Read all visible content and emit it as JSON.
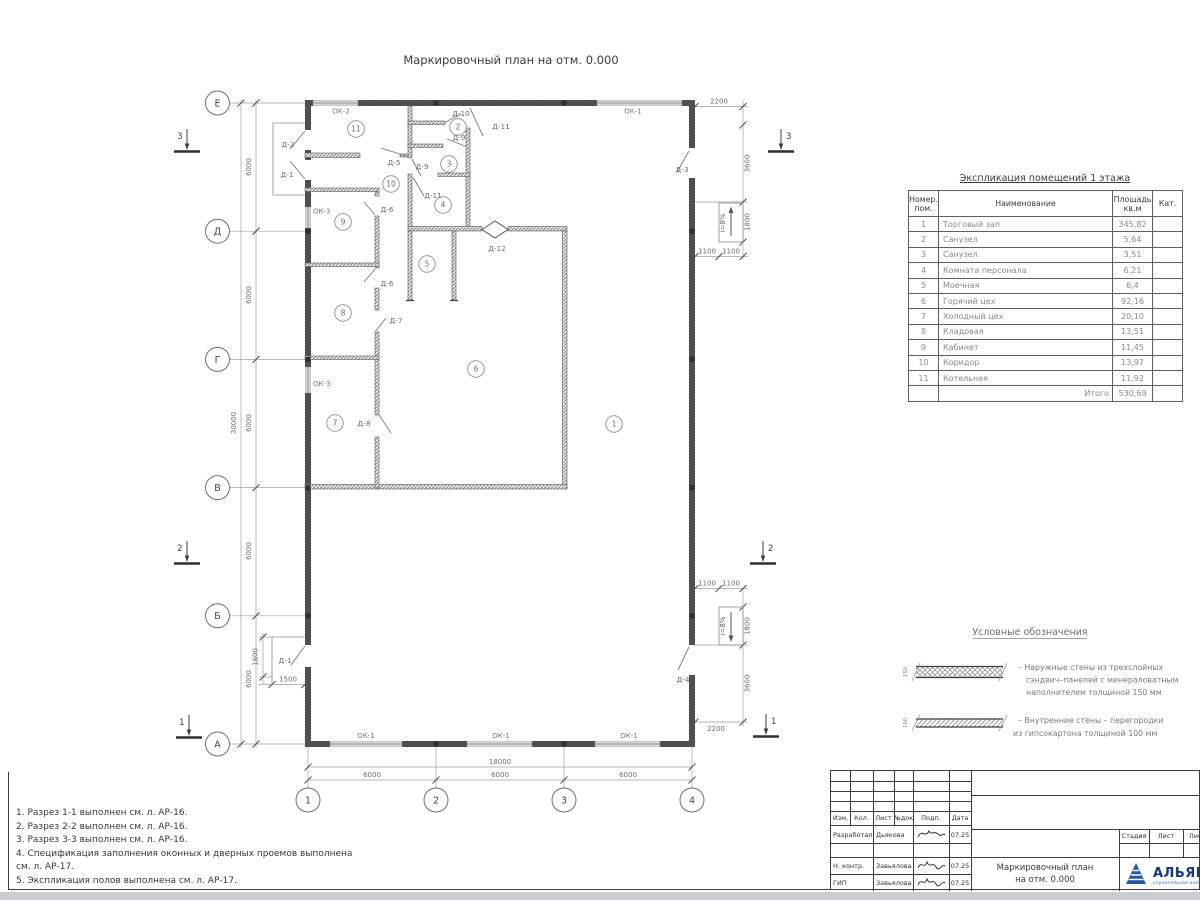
{
  "sheet": {
    "plan_title": "Маркировочный план на отм. 0.000"
  },
  "axes": {
    "rows": [
      "Е",
      "Д",
      "Г",
      "В",
      "Б",
      "А"
    ],
    "cols": [
      "1",
      "2",
      "3",
      "4"
    ]
  },
  "sections": {
    "s1": "1",
    "s2": "2",
    "s3": "3"
  },
  "rooms": [
    "1",
    "2",
    "3",
    "4",
    "5",
    "6",
    "7",
    "8",
    "9",
    "10",
    "11"
  ],
  "doors": {
    "d1": "Д-1",
    "d2": "Д-2",
    "d3": "Д-3",
    "d4": "Д-4",
    "d5": "Д-5",
    "d6": "Д-6",
    "d7": "Д-7",
    "d8": "Д-8",
    "d9": "Д-9",
    "d10": "Д-10",
    "d11": "Д-11",
    "d12": "Д-12"
  },
  "windows": {
    "ok1": "ОК-1",
    "ok2": "ОК-2",
    "ok3": "ОК-3"
  },
  "dims": {
    "d6000": "6000",
    "d18000": "18000",
    "d30000": "30000",
    "d2200": "2200",
    "d3600": "3600",
    "d1800": "1800",
    "d1100": "1100",
    "d1500": "1500",
    "ramp": "i=8%",
    "w150": "150",
    "w100": "100"
  },
  "table": {
    "title": "Экспликация помещений 1 этажа",
    "h_num1": "Номер.",
    "h_num2": "пом.",
    "h_name": "Наименование",
    "h_area1": "Площадь",
    "h_area2": "кв.м",
    "h_cat": "Кат.",
    "rows": [
      {
        "n": "1",
        "name": "Торговый зал",
        "area": "345,82"
      },
      {
        "n": "2",
        "name": "Санузел",
        "area": "5,64"
      },
      {
        "n": "3",
        "name": "Санузел",
        "area": "3,51"
      },
      {
        "n": "4",
        "name": "Комната персонала",
        "area": "6,21"
      },
      {
        "n": "5",
        "name": "Моечная",
        "area": "6,4"
      },
      {
        "n": "6",
        "name": "Горячий цех",
        "area": "92,16"
      },
      {
        "n": "7",
        "name": "Холодный цех",
        "area": "20,10"
      },
      {
        "n": "8",
        "name": "Кладовая",
        "area": "13,51"
      },
      {
        "n": "9",
        "name": "Кабинет",
        "area": "11,45"
      },
      {
        "n": "10",
        "name": "Коридор",
        "area": "13,97"
      },
      {
        "n": "11",
        "name": "Котельная",
        "area": "11,92"
      }
    ],
    "total_label": "Итого",
    "total": "530,69"
  },
  "legend": {
    "title": "Условные обозначения",
    "i1l1": "–  Наружные стены из трехслойных",
    "i1l2": "сэндвич–панелей с минераловатным",
    "i1l3": "наполнителем толщиной 150 мм",
    "i2l1": "–  Внутренние стены – перегородки",
    "i2l2": "из гипсокартона толщиной 100 мм"
  },
  "notes": {
    "l1": "1. Разрез 1-1 выполнен см. л. АР-16.",
    "l2": "2. Разрез 2-2 выполнен см. л. АР-16.",
    "l3": "3. Разрез 3-3 выполнен см. л. АР-16.",
    "l4": "4. Спецификация заполнения оконных и дверных проемов выполнена",
    "l5": "см. л. АР-17.",
    "l6": "5. Экспликация полов выполнена см. л. АР-17."
  },
  "titleblock": {
    "izm": "Изм.",
    "kol": "Кол.",
    "list": "Лист",
    "ndok": "№док",
    "podp": "Подп.",
    "data": "Дата",
    "r1_role": "Разработал",
    "r1_name": "Дьякова",
    "r1_date": "07.25",
    "r2_role": "Н. контр.",
    "r2_name": "Завьялова",
    "r2_date": "07.25",
    "r3_role": "ГИП",
    "r3_name": "Завьялова",
    "r3_date": "07.25",
    "stage": "Стадия",
    "sheet": "Лист",
    "sheets": "Листов",
    "doc1": "Маркировочный план",
    "doc2": "на отм. 0.000",
    "company": "АЛЬЯНС",
    "company_sub": "строительная компания"
  }
}
